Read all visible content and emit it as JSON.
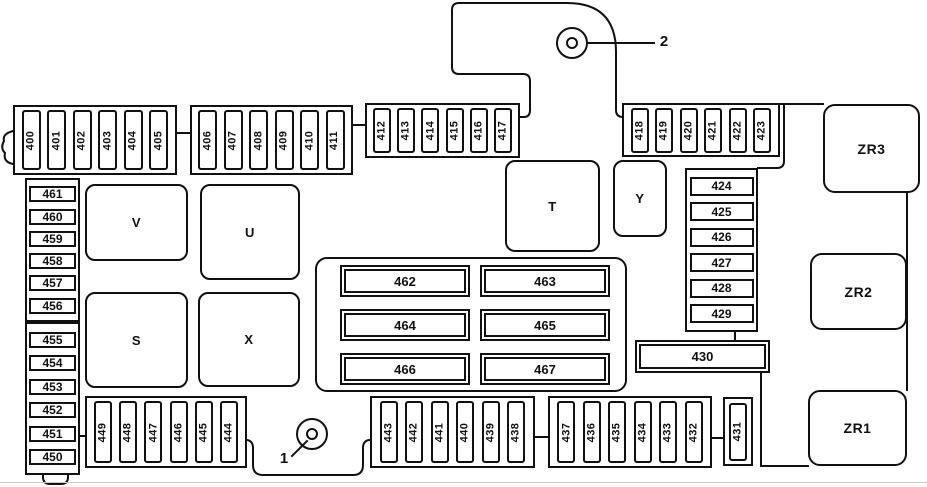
{
  "diagram_title": "Fuse box diagram (rear trunk fuse panel)",
  "fuses": {
    "top_row_1": [
      "400",
      "401",
      "402",
      "403",
      "404",
      "405"
    ],
    "top_row_2": [
      "406",
      "407",
      "408",
      "409",
      "410",
      "411"
    ],
    "top_row_3": [
      "412",
      "413",
      "414",
      "415",
      "416",
      "417"
    ],
    "top_row_4": [
      "418",
      "419",
      "420",
      "421",
      "422",
      "423"
    ],
    "left_col_upper": [
      "461",
      "460",
      "459",
      "458",
      "457",
      "456"
    ],
    "left_col_lower": [
      "455",
      "454",
      "453",
      "452",
      "451",
      "450"
    ],
    "right_col": [
      "424",
      "425",
      "426",
      "427",
      "428",
      "429"
    ],
    "center": [
      "462",
      "463",
      "464",
      "465",
      "466",
      "467"
    ],
    "bottom_row_1": [
      "449",
      "448",
      "447",
      "446",
      "445",
      "444"
    ],
    "bottom_row_2": [
      "443",
      "442",
      "441",
      "440",
      "439",
      "438"
    ],
    "bottom_row_3": [
      "437",
      "436",
      "435",
      "434",
      "433",
      "432"
    ],
    "f430": "430",
    "f431": "431"
  },
  "relays": {
    "v": "V",
    "u": "U",
    "s": "S",
    "x": "X",
    "t": "T",
    "y": "Y",
    "zr1": "ZR1",
    "zr2": "ZR2",
    "zr3": "ZR3"
  },
  "markers": {
    "m1": "1",
    "m2": "2"
  },
  "colors": {
    "line": "#111111",
    "background": "#ffffff"
  }
}
